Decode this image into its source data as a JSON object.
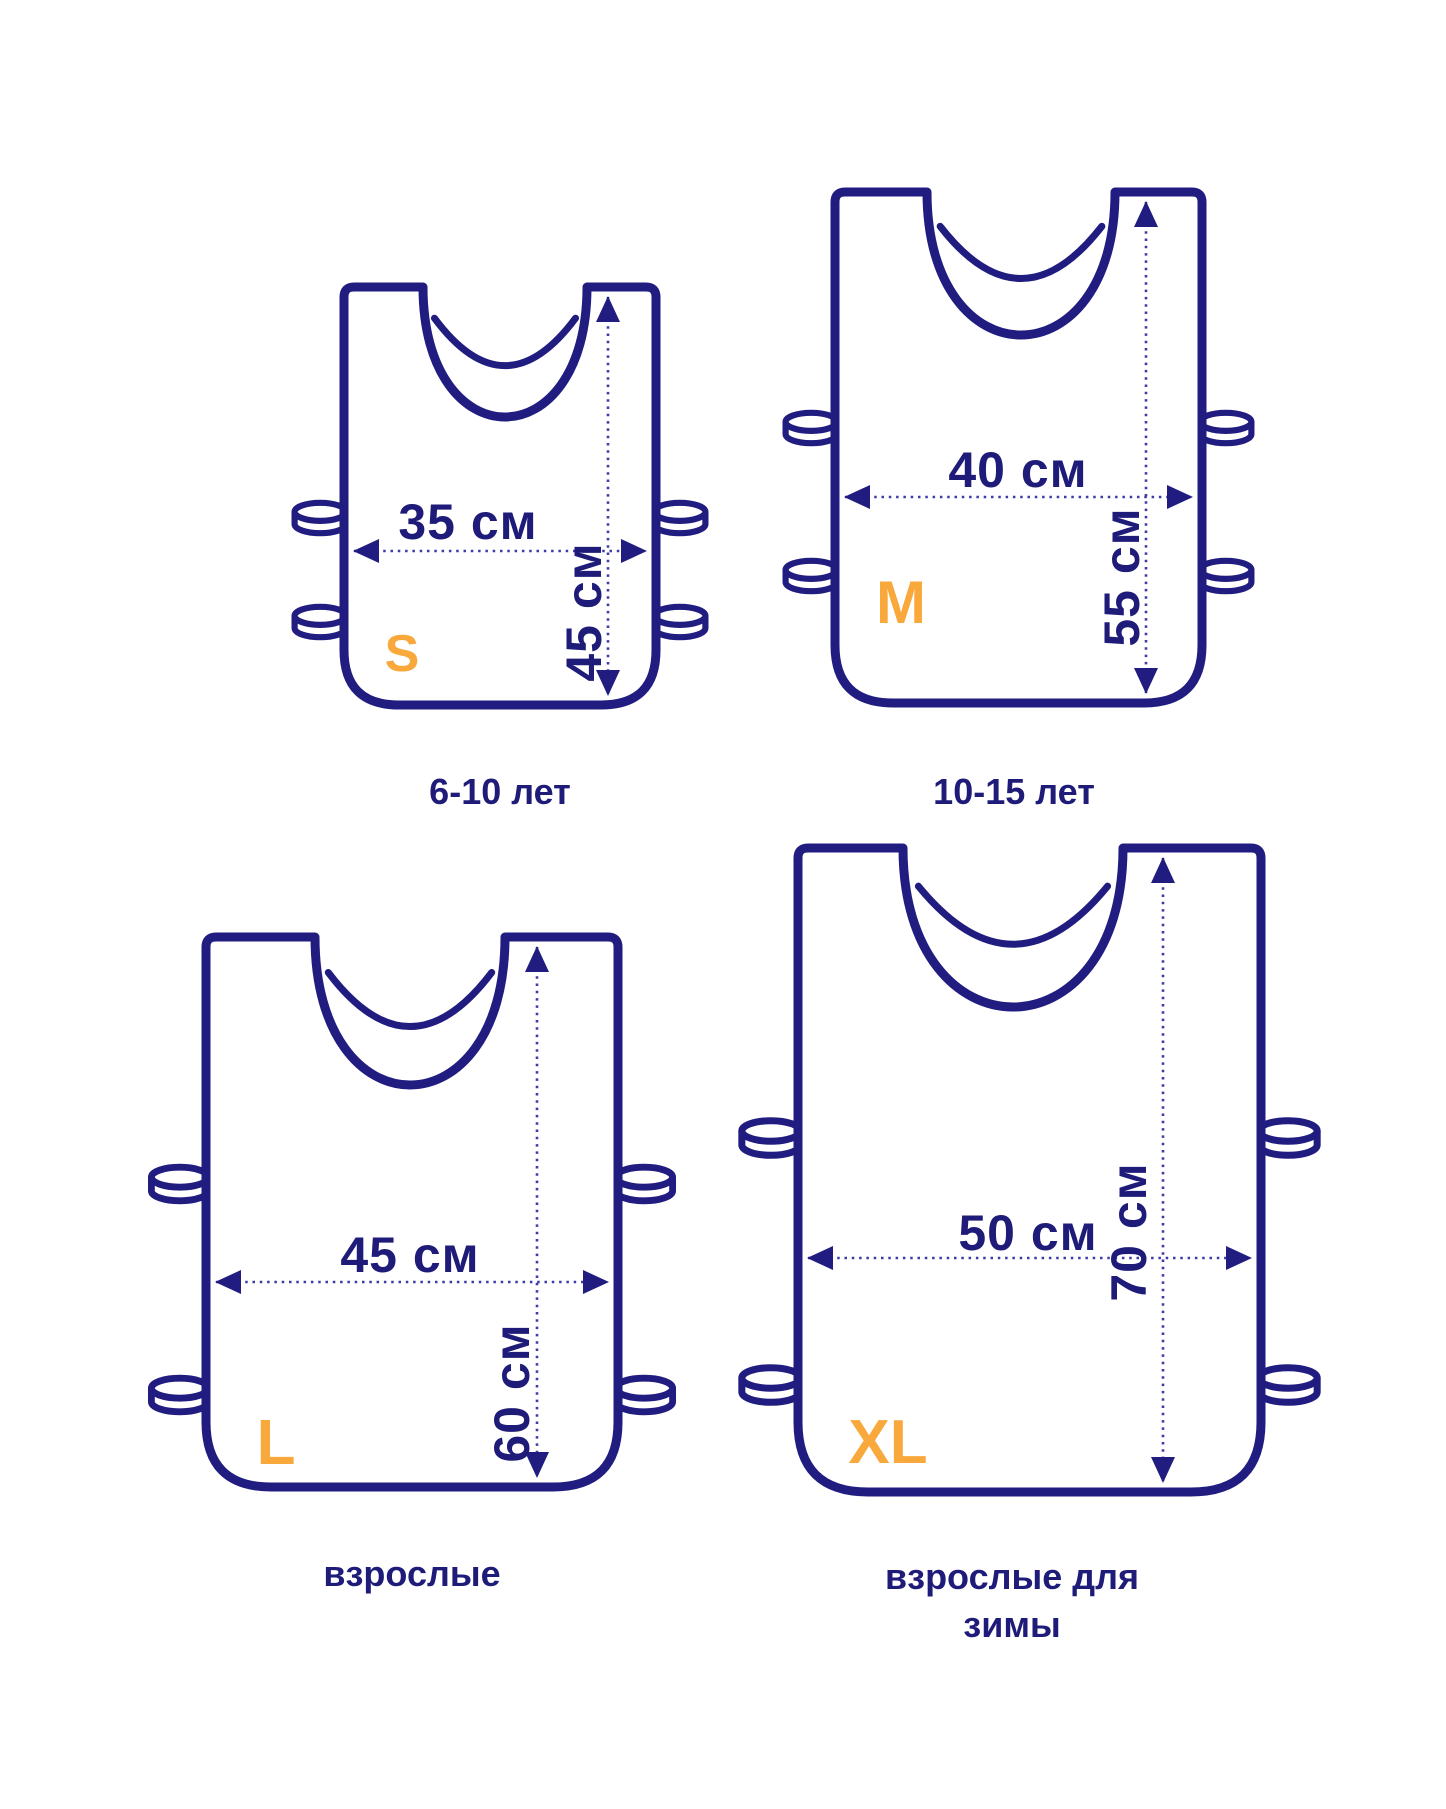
{
  "page": {
    "background": "#ffffff",
    "description_unit": "см"
  },
  "colors": {
    "outline_navy": "#211d80",
    "text_navy": "#1e1b79",
    "dashed_line": "#3e3ba6",
    "accent_orange": "#F9A83B",
    "vest_fill": "#ffffff"
  },
  "vests": [
    {
      "size_letter": "S",
      "width_cm": 35,
      "height_cm": 45,
      "width_label": "35 см",
      "height_label": "45 см",
      "age_label": "6-10 лет"
    },
    {
      "size_letter": "M",
      "width_cm": 40,
      "height_cm": 55,
      "width_label": "40 см",
      "height_label": "55 см",
      "age_label": "10-15 лет"
    },
    {
      "size_letter": "L",
      "width_cm": 45,
      "height_cm": 60,
      "width_label": "45 см",
      "height_label": "60 см",
      "age_label": "взрослые"
    },
    {
      "size_letter": "XL",
      "width_cm": 50,
      "height_cm": 70,
      "width_label": "50 см",
      "height_label": "70 см",
      "age_label": "взрослые для зимы",
      "age_label_lines": [
        "взрослые для",
        "зимы"
      ]
    }
  ]
}
